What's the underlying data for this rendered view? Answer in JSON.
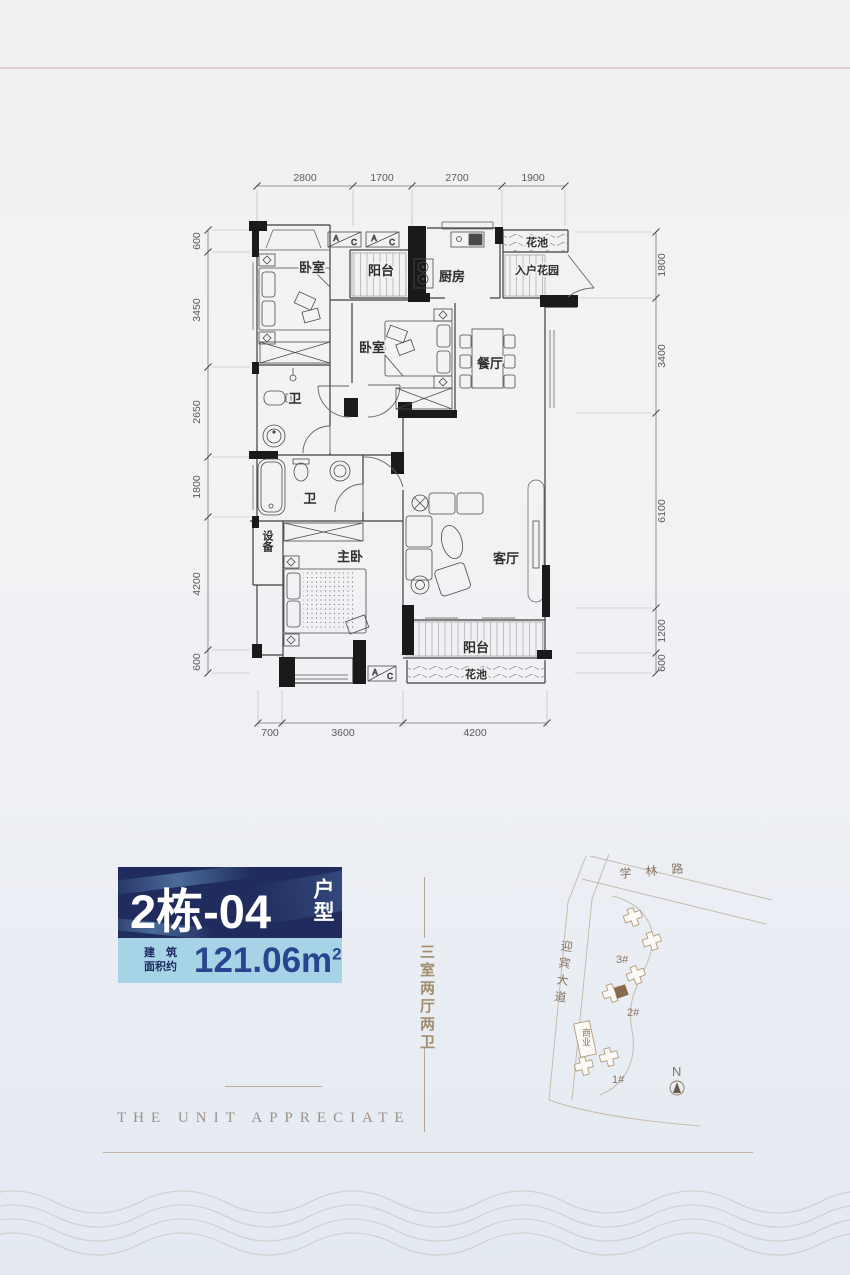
{
  "colors": {
    "brand_navy": "#202b5e",
    "light_blue": "#a7d3e6",
    "area_text_blue": "#2a4590",
    "tan_accent": "#a38d6d",
    "map_highlight_brown": "#8a6a4e"
  },
  "floor_plan": {
    "dimensions": {
      "top": [
        "2800",
        "1700",
        "2700",
        "1900"
      ],
      "left": [
        "600",
        "3450",
        "2650",
        "1800",
        "4200",
        "600"
      ],
      "right": [
        "1800",
        "3400",
        "6100",
        "1200",
        "600"
      ],
      "bottom": [
        "700",
        "3600",
        "4200"
      ]
    },
    "rooms": {
      "bedroom_top": "卧室",
      "balcony_top": "阳台",
      "kitchen": "厨房",
      "flower_bed_top": "花池",
      "entry_garden": "入户花园",
      "bedroom_mid": "卧室",
      "dining": "餐厅",
      "bath_upper": "卫",
      "bath_lower": "卫",
      "equipment": "设备",
      "master_bedroom": "主卧",
      "living": "客厅",
      "balcony_bottom": "阳台",
      "flower_bed_bottom": "花池"
    },
    "ac": {
      "a": "A",
      "c": "C"
    }
  },
  "badge": {
    "unit_number": "2栋-04",
    "unit_suffix": "户型",
    "area_label_line1": "建筑",
    "area_label_line2": "面积约",
    "area_value": "121.06m",
    "area_superscript": "2"
  },
  "tagline": {
    "layout_vertical": "三室两厅两卫",
    "english": "THE UNIT APPRECIATE"
  },
  "site_map": {
    "road_top": "学林路",
    "road_left": "迎宾大道",
    "building_3": "3#",
    "building_2": "2#",
    "building_1": "1#",
    "commercial": "商业",
    "compass_north": "N"
  }
}
